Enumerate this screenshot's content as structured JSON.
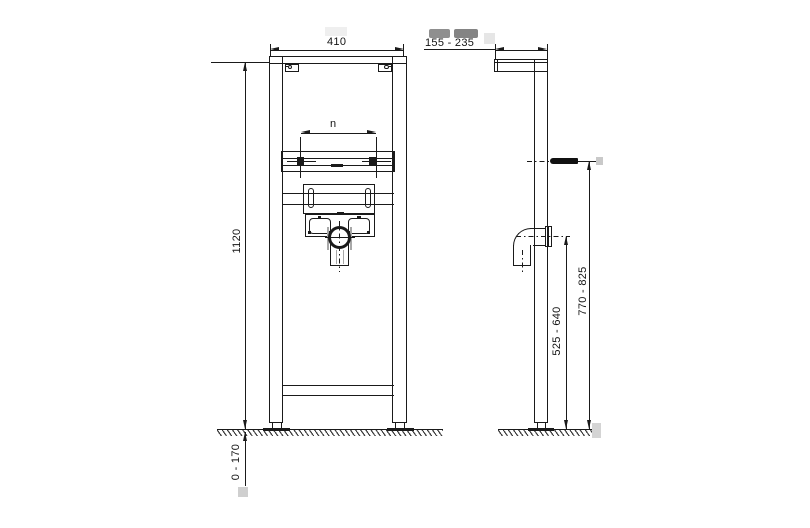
{
  "labels": {
    "front_width": "410",
    "front_height": "1120",
    "fixture_centers": "n",
    "leg_adjustment": "0 - 170",
    "side_depth": "155 - 235",
    "drain_outlet_height": "525 - 640",
    "stud_height": "770 - 825"
  },
  "colors": {
    "line": "#1a1a1a",
    "background": "#ffffff",
    "hidden_line": "#a8a8a8",
    "redaction_dark": "#8c8c8c",
    "redaction_light": "#e9e9e9",
    "gray_marker": "#c9c9c9"
  }
}
